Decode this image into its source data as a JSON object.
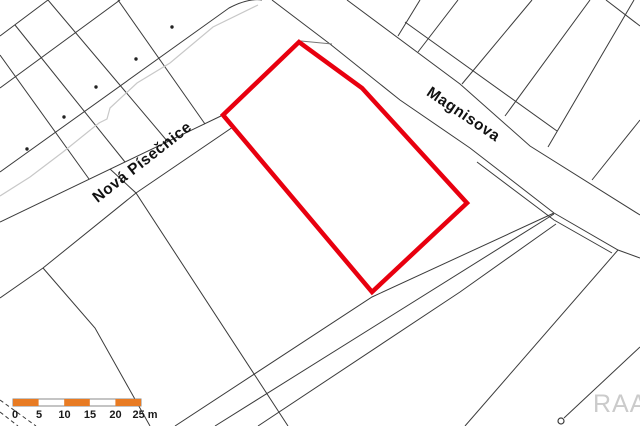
{
  "map": {
    "streets": {
      "nova_pisecnice": "Nová Písečnice",
      "magnisova": "Magnisova"
    },
    "scale_bar": {
      "tick_labels": [
        "0",
        "5",
        "10",
        "15",
        "20",
        "25 m"
      ]
    },
    "watermark": "RAA",
    "colors": {
      "highlight_red": "#e8000f",
      "scale_orange": "#e87b23",
      "boundary_gray": "#3b3b3b",
      "light_gray": "#c8c8c8"
    }
  }
}
